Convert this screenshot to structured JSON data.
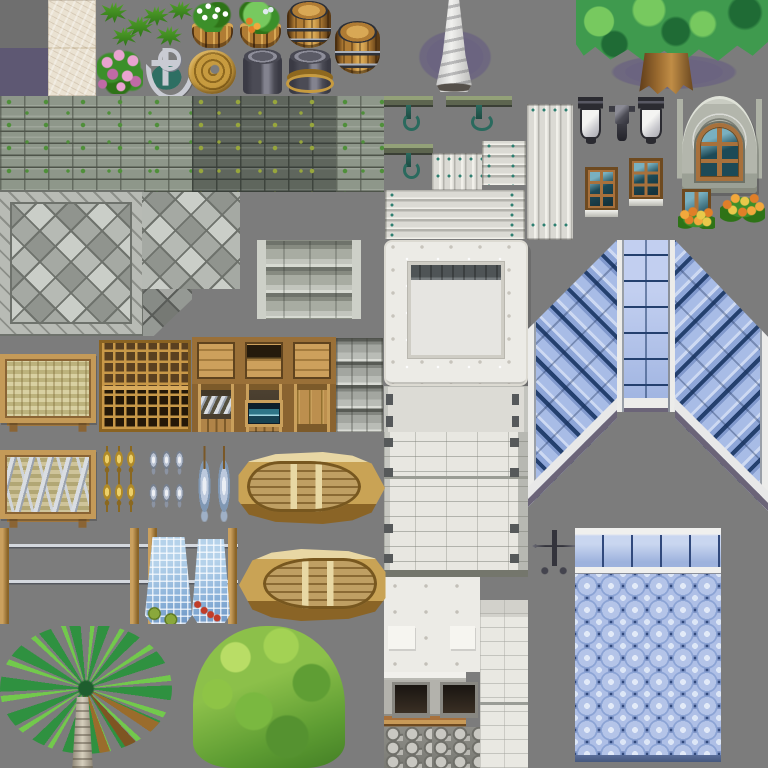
{
  "meta": {
    "title": "seaside-town-game-tileset",
    "sheet_width": 768,
    "sheet_height": 768,
    "grid_size": 48
  },
  "palette": {
    "bg": "#7c7c7c",
    "bgDark": "#6f6f6f",
    "purpleTile": "#5e5873",
    "purpleShadow": "#6b6480",
    "marble": "#d9cdb6",
    "marbleLight": "#eae2d2",
    "grass": "#54a42c",
    "grassDark": "#2e7317",
    "leaf": "#3c8f2a",
    "pink": "#e9a3d0",
    "pinkDark": "#c06aa6",
    "silver": "#c9cbd3",
    "silverDark": "#787b88",
    "teal": "#2e6f63",
    "gold": "#c79b3f",
    "goldDark": "#8e681f",
    "barrel": "#b07c34",
    "barrelLight": "#d8a855",
    "barrelDark": "#5d3c16",
    "bandLight": "#aab0bb",
    "bucket": "#4b4b55",
    "bucketLight": "#83838f",
    "iron": "#2b2b31",
    "stucco": "#ecebe6",
    "stone": "#a8aca2",
    "stoneLight": "#c2c5bd",
    "wallLight": "#8e978a",
    "wallDark": "#5f665d",
    "wallLine": "#4e544a",
    "moss": "#4f8f3a",
    "mossYellow": "#97a63c",
    "pave": "#b2b6b0",
    "paveLight": "#c4c8c2",
    "paveDark": "#9b9f99",
    "paveLine": "#6e726c",
    "plank": "#dbdad4",
    "plankShadow": "#b3b2ac",
    "nailTeal": "#2e7f71",
    "frame": "#a8713c",
    "frameDark": "#6e4a20",
    "glass": "#1d4a57",
    "glassLight": "#79b0c0",
    "archStone": "#b3b6ac",
    "orange": "#e07f28",
    "orangeLight": "#f2a83c",
    "tree": "#3f9a4e",
    "treeLight": "#77c95f",
    "treeDark": "#1f6b35",
    "roofNavy": "#24406e",
    "scale": "#b4c4e8",
    "scaleLight": "#e2eaf8",
    "scaleDark": "#31497c",
    "boat": "#c9a355",
    "boatLight": "#e8d7a4",
    "boatDark": "#8a6426",
    "floatGreen": "#8aa83c",
    "floatRed": "#c13c28",
    "palmGreen": "#2f9140"
  },
  "tiles": [
    {
      "name": "plain-dark-tile",
      "type": "fill-dark",
      "x": 0,
      "y": 0,
      "w": 48,
      "h": 48
    },
    {
      "name": "plain-purple-tile",
      "type": "fill-purple",
      "x": 0,
      "y": 48,
      "w": 48,
      "h": 48
    },
    {
      "name": "marble-tile",
      "type": "marble",
      "x": 48,
      "y": 0,
      "w": 48,
      "h": 96
    },
    {
      "name": "grass-tuft",
      "type": "grass-tuft",
      "x": 100,
      "y": 2,
      "w": 27,
      "h": 21
    },
    {
      "name": "grass-tuft",
      "type": "grass-tuft",
      "x": 126,
      "y": 16,
      "w": 27,
      "h": 21
    },
    {
      "name": "grass-tuft",
      "type": "grass-tuft",
      "x": 112,
      "y": 27,
      "w": 25,
      "h": 19
    },
    {
      "name": "grass-tuft",
      "type": "grass-tuft",
      "x": 143,
      "y": 6,
      "w": 26,
      "h": 20
    },
    {
      "name": "grass-tuft",
      "type": "grass-tuft",
      "x": 156,
      "y": 26,
      "w": 26,
      "h": 20
    },
    {
      "name": "grass-tuft",
      "type": "grass-tuft",
      "x": 168,
      "y": 1,
      "w": 25,
      "h": 19
    },
    {
      "name": "pink-flowers",
      "type": "flowers-pink",
      "x": 97,
      "y": 49,
      "w": 46,
      "h": 45
    },
    {
      "name": "anchor",
      "type": "anchor",
      "x": 142,
      "y": 48,
      "w": 47,
      "h": 47
    },
    {
      "name": "flower-barrel-planter",
      "type": "planter-flowers",
      "x": 189,
      "y": 2,
      "w": 47,
      "h": 46
    },
    {
      "name": "rope-coil",
      "type": "rope-coil",
      "x": 188,
      "y": 50,
      "w": 48,
      "h": 44
    },
    {
      "name": "bush-planter",
      "type": "planter-bush",
      "x": 237,
      "y": 2,
      "w": 47,
      "h": 46
    },
    {
      "name": "metal-bucket",
      "type": "bucket",
      "x": 243,
      "y": 50,
      "w": 39,
      "h": 44
    },
    {
      "name": "wooden-barrel",
      "type": "barrel",
      "x": 287,
      "y": 2,
      "w": 44,
      "h": 46
    },
    {
      "name": "bucket-with-rope",
      "type": "bucket-rope",
      "x": 289,
      "y": 50,
      "w": 42,
      "h": 44
    },
    {
      "name": "wooden-barrel",
      "type": "barrel",
      "x": 335,
      "y": 22,
      "w": 45,
      "h": 52
    },
    {
      "name": "spire-shadow",
      "type": "shadow-ellipse",
      "x": 404,
      "y": 20,
      "w": 102,
      "h": 74
    },
    {
      "name": "coral-spire",
      "type": "spire",
      "x": 428,
      "y": 0,
      "w": 52,
      "h": 92
    },
    {
      "name": "tree-shadow",
      "type": "shadow-ellipse",
      "x": 586,
      "y": 48,
      "w": 176,
      "h": 48
    },
    {
      "name": "large-tree",
      "type": "big-tree",
      "x": 576,
      "y": 0,
      "w": 192,
      "h": 96
    },
    {
      "name": "mossy-stone-wall-light",
      "type": "wall-moss",
      "x": 0,
      "y": 96,
      "w": 192,
      "h": 96
    },
    {
      "name": "mossy-stone-wall-dark",
      "type": "wall-moss dark",
      "x": 192,
      "y": 96,
      "w": 144,
      "h": 96
    },
    {
      "name": "mossy-stone-wall-light",
      "type": "wall-moss",
      "x": 336,
      "y": 96,
      "w": 48,
      "h": 96
    },
    {
      "name": "hanging-beam",
      "type": "beam-hook",
      "x": 384,
      "y": 96,
      "w": 49,
      "h": 36
    },
    {
      "name": "hanging-beam",
      "type": "beam-hook",
      "x": 446,
      "y": 96,
      "w": 66,
      "h": 36
    },
    {
      "name": "hanging-beam",
      "type": "beam-hook",
      "x": 384,
      "y": 144,
      "w": 49,
      "h": 36
    },
    {
      "name": "plank-stack-vertical-short",
      "type": "planks-v",
      "x": 432,
      "y": 153,
      "w": 50,
      "h": 38
    },
    {
      "name": "plank-stack-horizontal-small",
      "type": "planks-h",
      "x": 482,
      "y": 141,
      "w": 44,
      "h": 44
    },
    {
      "name": "plank-stack-vertical-tall",
      "type": "planks-v",
      "x": 527,
      "y": 104,
      "w": 46,
      "h": 136
    },
    {
      "name": "plank-stack-horizontal-wide",
      "type": "planks-h",
      "x": 385,
      "y": 190,
      "w": 140,
      "h": 49
    },
    {
      "name": "iron-lantern",
      "type": "lantern",
      "x": 578,
      "y": 97,
      "w": 25,
      "h": 47
    },
    {
      "name": "lamp-bracket",
      "type": "lamp-bracket",
      "x": 606,
      "y": 102,
      "w": 32,
      "h": 42
    },
    {
      "name": "iron-lantern",
      "type": "lantern",
      "x": 638,
      "y": 97,
      "w": 26,
      "h": 47
    },
    {
      "name": "stone-arch-window",
      "type": "arch-door",
      "x": 677,
      "y": 96,
      "w": 85,
      "h": 97
    },
    {
      "name": "six-pane-window",
      "type": "window",
      "x": 585,
      "y": 167,
      "w": 33,
      "h": 44
    },
    {
      "name": "six-pane-window",
      "type": "window",
      "x": 629,
      "y": 158,
      "w": 34,
      "h": 42
    },
    {
      "name": "window-flower-box",
      "type": "window-flowerbox",
      "x": 678,
      "y": 189,
      "w": 37,
      "h": 40
    },
    {
      "name": "orange-flower-bush",
      "type": "flowerbush",
      "x": 720,
      "y": 191,
      "w": 45,
      "h": 34
    },
    {
      "name": "paved-plaza-bordered",
      "type": "paved-border",
      "x": 0,
      "y": 192,
      "w": 142,
      "h": 142
    },
    {
      "name": "paved-floor",
      "type": "paved",
      "x": 142,
      "y": 192,
      "w": 98,
      "h": 97
    },
    {
      "name": "paved-floor-corner",
      "type": "paved corner",
      "x": 143,
      "y": 289,
      "w": 49,
      "h": 47
    },
    {
      "name": "stone-steps",
      "type": "steps",
      "x": 257,
      "y": 240,
      "w": 104,
      "h": 79
    },
    {
      "name": "white-building-front",
      "type": "stucco-building",
      "x": 384,
      "y": 240,
      "w": 144,
      "h": 146
    },
    {
      "name": "riveted-wall-section",
      "type": "wall-clips",
      "x": 384,
      "y": 386,
      "w": 144,
      "h": 46
    },
    {
      "name": "white-brick-wall",
      "type": "wall-brick",
      "x": 384,
      "y": 432,
      "w": 144,
      "h": 145
    },
    {
      "name": "roof-slope-left",
      "type": "roof-slope-left",
      "x": 528,
      "y": 240,
      "w": 94,
      "h": 280
    },
    {
      "name": "roof-ridge",
      "type": "roof-ridge",
      "x": 617,
      "y": 240,
      "w": 58,
      "h": 172
    },
    {
      "name": "roof-slope-right",
      "type": "roof-slope-right",
      "x": 672,
      "y": 240,
      "w": 96,
      "h": 280
    },
    {
      "name": "stucco-blocks",
      "type": "stucco-block",
      "x": 384,
      "y": 577,
      "w": 96,
      "h": 95
    },
    {
      "name": "stone-oven",
      "type": "oven",
      "x": 384,
      "y": 672,
      "w": 48,
      "h": 96
    },
    {
      "name": "stone-oven-partial",
      "type": "oven partial",
      "x": 432,
      "y": 672,
      "w": 48,
      "h": 96
    },
    {
      "name": "white-wall-column",
      "type": "wall-column",
      "x": 480,
      "y": 600,
      "w": 48,
      "h": 168
    },
    {
      "name": "weathervane-rooster",
      "type": "weathervane",
      "x": 531,
      "y": 525,
      "w": 46,
      "h": 52
    },
    {
      "name": "scalloped-roof",
      "type": "scallop-roof",
      "x": 575,
      "y": 528,
      "w": 146,
      "h": 234
    },
    {
      "name": "woven-mat-table",
      "type": "woven-table",
      "x": 0,
      "y": 354,
      "w": 96,
      "h": 78
    },
    {
      "name": "lattice-rack",
      "type": "lattice",
      "x": 99,
      "y": 340,
      "w": 92,
      "h": 92
    },
    {
      "name": "crate-lid",
      "type": "crate-lid",
      "x": 192,
      "y": 337,
      "w": 48,
      "h": 47
    },
    {
      "name": "crate-with-fish",
      "type": "crate-fish",
      "x": 192,
      "y": 384,
      "w": 48,
      "h": 48
    },
    {
      "name": "crate-shelf",
      "type": "crate-shelf",
      "x": 240,
      "y": 337,
      "w": 48,
      "h": 47
    },
    {
      "name": "crate-aquarium",
      "type": "crate-blue",
      "x": 240,
      "y": 384,
      "w": 48,
      "h": 48
    },
    {
      "name": "crate-lid",
      "type": "crate-lid",
      "x": 288,
      "y": 337,
      "w": 48,
      "h": 47
    },
    {
      "name": "crate-door",
      "type": "crate-door",
      "x": 288,
      "y": 384,
      "w": 48,
      "h": 48
    },
    {
      "name": "stone-block-stack",
      "type": "stone-stack",
      "x": 336,
      "y": 338,
      "w": 47,
      "h": 94
    },
    {
      "name": "fish-market-table",
      "type": "fish-table",
      "x": 0,
      "y": 450,
      "w": 96,
      "h": 78
    },
    {
      "name": "dried-fish-skewers",
      "type": "skewers",
      "x": 101,
      "y": 446,
      "w": 36,
      "h": 66
    },
    {
      "name": "hanging-fish-bundle",
      "type": "fish-bundle",
      "x": 147,
      "y": 446,
      "w": 39,
      "h": 66
    },
    {
      "name": "hanging-fish-pair",
      "type": "fish-pair",
      "x": 195,
      "y": 446,
      "w": 39,
      "h": 76
    },
    {
      "name": "rowboat",
      "type": "boat",
      "x": 237,
      "y": 452,
      "w": 148,
      "h": 72
    },
    {
      "name": "net-drying-rack",
      "type": "drying-rack",
      "x": 0,
      "y": 528,
      "w": 238,
      "h": 96
    },
    {
      "name": "fishing-net-green-floats",
      "type": "net",
      "x": 145,
      "y": 537,
      "w": 47,
      "h": 87
    },
    {
      "name": "fishing-net-red-floats",
      "type": "net red",
      "x": 192,
      "y": 539,
      "w": 38,
      "h": 84
    },
    {
      "name": "rowboat",
      "type": "boat left",
      "x": 239,
      "y": 549,
      "w": 148,
      "h": 72
    },
    {
      "name": "palm-tree",
      "type": "palm",
      "x": 0,
      "y": 626,
      "w": 172,
      "h": 142
    },
    {
      "name": "round-bush-tree",
      "type": "bush-tree",
      "x": 193,
      "y": 626,
      "w": 152,
      "h": 142
    }
  ]
}
